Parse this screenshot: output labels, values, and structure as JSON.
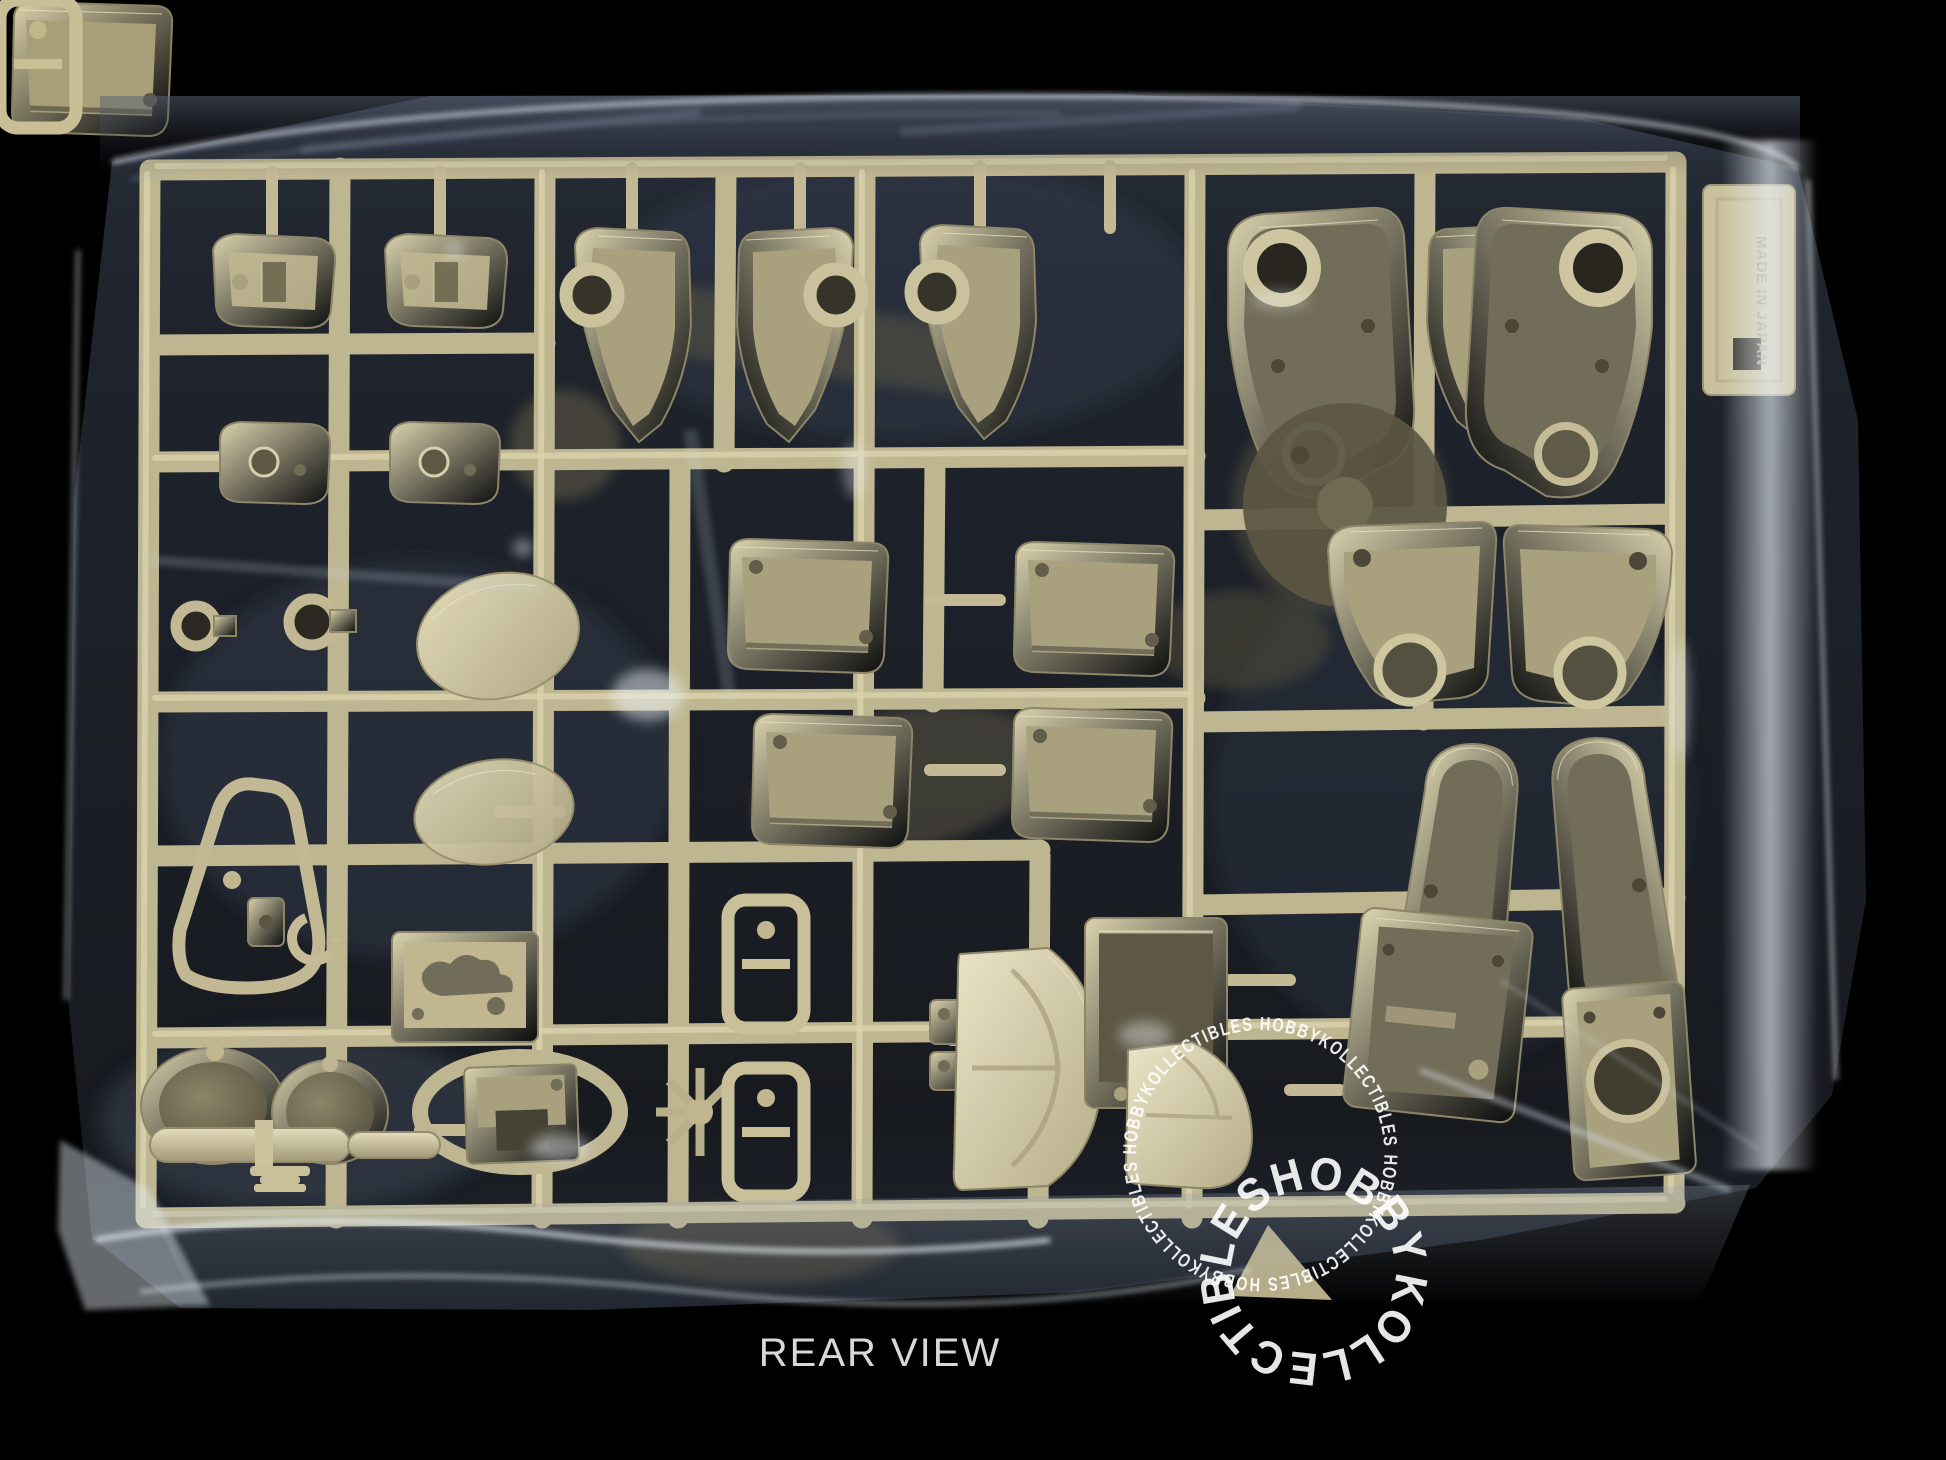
{
  "photo": {
    "caption": "REAR VIEW",
    "molded_text": "MADE IN JAPAN",
    "watermark": {
      "large_ring_text": "KOLLECTIBLESHOBBY",
      "small_ring_text": "HOBBYKOLLECTIBLES HOBBYKOLLECTIBLES HOBBYKOLLECTIBLES HOBBYKOLLECTIBLES ",
      "color": "#ffffff"
    },
    "colors": {
      "background": "#000000",
      "plastic_light": "#d8cfa8",
      "plastic_mid": "#b2a881",
      "plastic_dark": "#6e6750",
      "runner": "#beb48b",
      "bag_highlight": "#e9eff6",
      "bag_shadow": "#1c212b",
      "caption": "#d8d8d8"
    }
  }
}
